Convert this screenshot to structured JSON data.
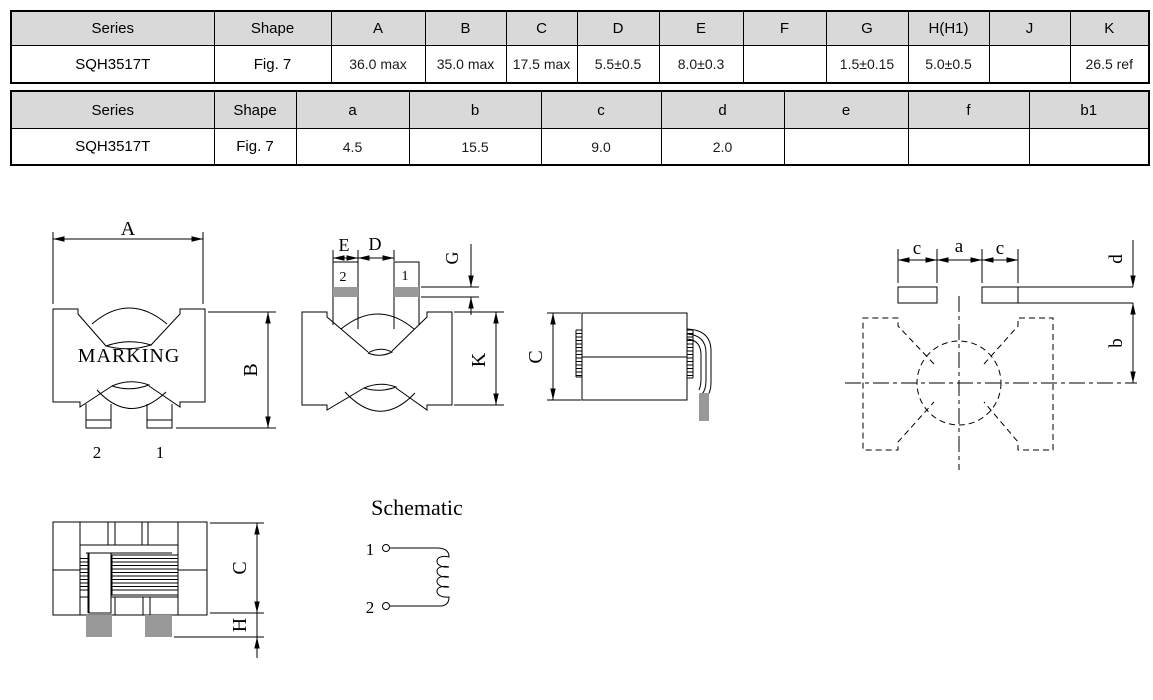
{
  "colors": {
    "background": "#ffffff",
    "line": "#000000",
    "pad_gray": "#999999",
    "table_header_bg": "#d9d9d9"
  },
  "table1": {
    "headers": [
      "Series",
      "Shape",
      "A",
      "B",
      "C",
      "D",
      "E",
      "F",
      "G",
      "H(H1)",
      "J",
      "K"
    ],
    "row": [
      "SQH3517T",
      "Fig. 7",
      "36.0 max",
      "35.0 max",
      "17.5 max",
      "5.5±0.5",
      "8.0±0.3",
      "",
      "1.5±0.15",
      "5.0±0.5",
      "",
      "26.5 ref"
    ]
  },
  "table2": {
    "headers": [
      "Series",
      "Shape",
      "a",
      "b",
      "c",
      "d",
      "e",
      "f",
      "b1"
    ],
    "row": [
      "SQH3517T",
      "Fig. 7",
      "4.5",
      "15.5",
      "9.0",
      "2.0",
      "",
      "",
      ""
    ]
  },
  "front_view": {
    "dim_width": "A",
    "dim_height": "B",
    "marking": "MARKING",
    "pin_left": "2",
    "pin_right": "1"
  },
  "bottom_view": {
    "dim_e": "E",
    "dim_d": "D",
    "dim_g": "G",
    "dim_k": "K",
    "pin_left": "2",
    "pin_right": "1"
  },
  "side_view": {
    "dim_c": "C"
  },
  "land_pattern": {
    "dim_c_left": "c",
    "dim_a": "a",
    "dim_c_right": "c",
    "dim_d": "d",
    "dim_b": "b"
  },
  "cross_section": {
    "dim_c": "C",
    "dim_h": "H"
  },
  "schematic": {
    "title": "Schematic",
    "pin1": "1",
    "pin2": "2"
  }
}
